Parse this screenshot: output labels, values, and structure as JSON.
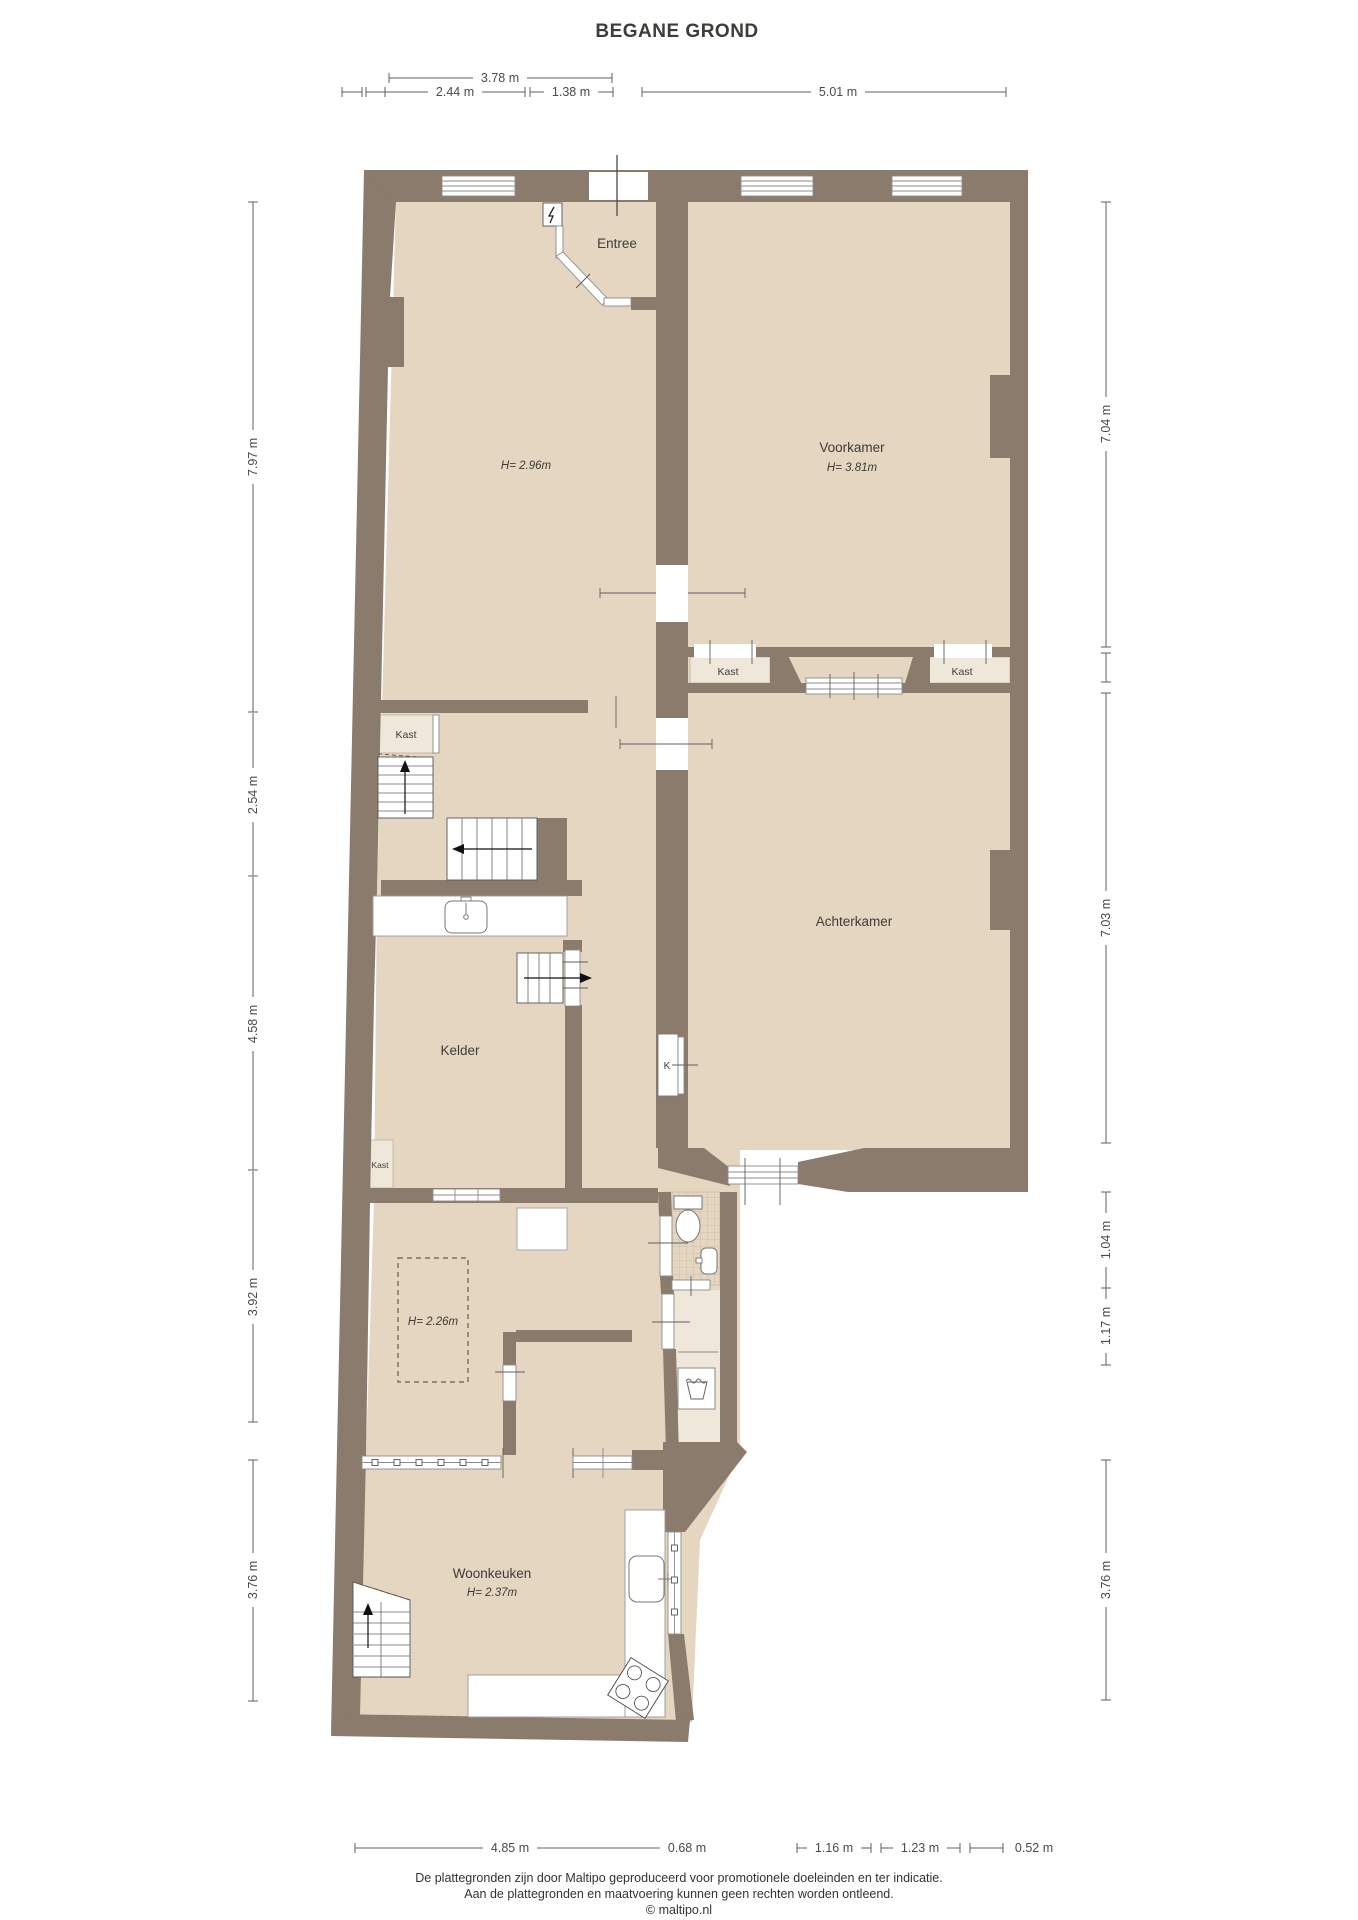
{
  "title": "BEGANE GROND",
  "colors": {
    "wall": "#8b7b6d",
    "floor": "#e4d6c1",
    "floor_light": "#efe8da",
    "tile_line": "#d0c0a7",
    "window_frame": "#8c8c8c",
    "dimension": "#5f5f5f"
  },
  "rooms": {
    "entree": {
      "label": "Entree"
    },
    "left_room": {
      "height": "H= 2.96m"
    },
    "voorkamer": {
      "label": "Voorkamer",
      "height": "H= 3.81m"
    },
    "achterkamer": {
      "label": "Achterkamer"
    },
    "kelder": {
      "label": "Kelder"
    },
    "middle_room": {
      "height": "H= 2.26m"
    },
    "woonkeuken": {
      "label": "Woonkeuken",
      "height": "H= 2.37m"
    },
    "kast_hall": {
      "label": "Kast"
    },
    "kast_kelder": {
      "label": "Kast"
    },
    "kast_row_left": {
      "label": "Kast"
    },
    "kast_row_right": {
      "label": "Kast"
    },
    "k_box": {
      "label": "K"
    }
  },
  "dimensions": {
    "top": [
      "3.78 m",
      "2.44 m",
      "1.38 m",
      "5.01 m"
    ],
    "left": [
      "7.97 m",
      "2.54 m",
      "4.58 m",
      "3.92 m",
      "3.76 m"
    ],
    "right": [
      "7.04 m",
      "7.03 m",
      "1.04 m",
      "1.17 m",
      "3.76 m"
    ],
    "bottom": [
      "4.85 m",
      "0.68 m",
      "1.16 m",
      "1.23 m",
      "0.52 m"
    ]
  },
  "footer": {
    "line1": "De plattegronden zijn door Maltipo geproduceerd voor promotionele doeleinden en ter indicatie.",
    "line2": "Aan de plattegronden en maatvoering kunnen geen rechten worden ontleend.",
    "line3": "© maltipo.nl"
  }
}
